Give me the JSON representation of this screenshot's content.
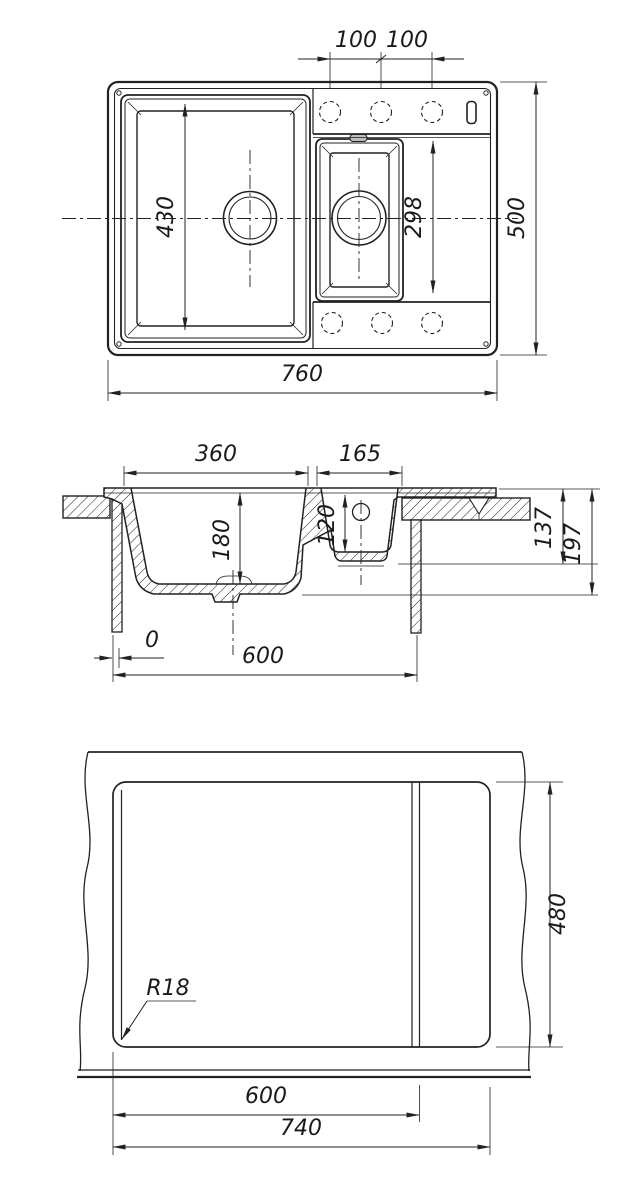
{
  "document": {
    "type": "technical-drawing",
    "subject": "kitchen sink with one-and-a-half bowls, three orthographic views",
    "line_color": "#222222",
    "background": "#ffffff"
  },
  "top_view": {
    "faucet_hole_spacing_left": "100",
    "faucet_hole_spacing_right": "100",
    "left_bowl_length": "430",
    "right_section_length": "298",
    "overall_length": "760",
    "overall_width": "500"
  },
  "section_view": {
    "left_bowl_width": "360",
    "right_bowl_width": "165",
    "left_bowl_depth": "180",
    "right_bowl_depth": "120",
    "height_to_small_bowl_bottom": "137",
    "height_to_main_bowl_bottom": "197",
    "side_offset": "0",
    "cabinet_width": "600"
  },
  "cutout_view": {
    "corner_radius": "R18",
    "cutout_depth": "480",
    "cutout_width_to_step": "600",
    "cutout_width_total": "740"
  }
}
